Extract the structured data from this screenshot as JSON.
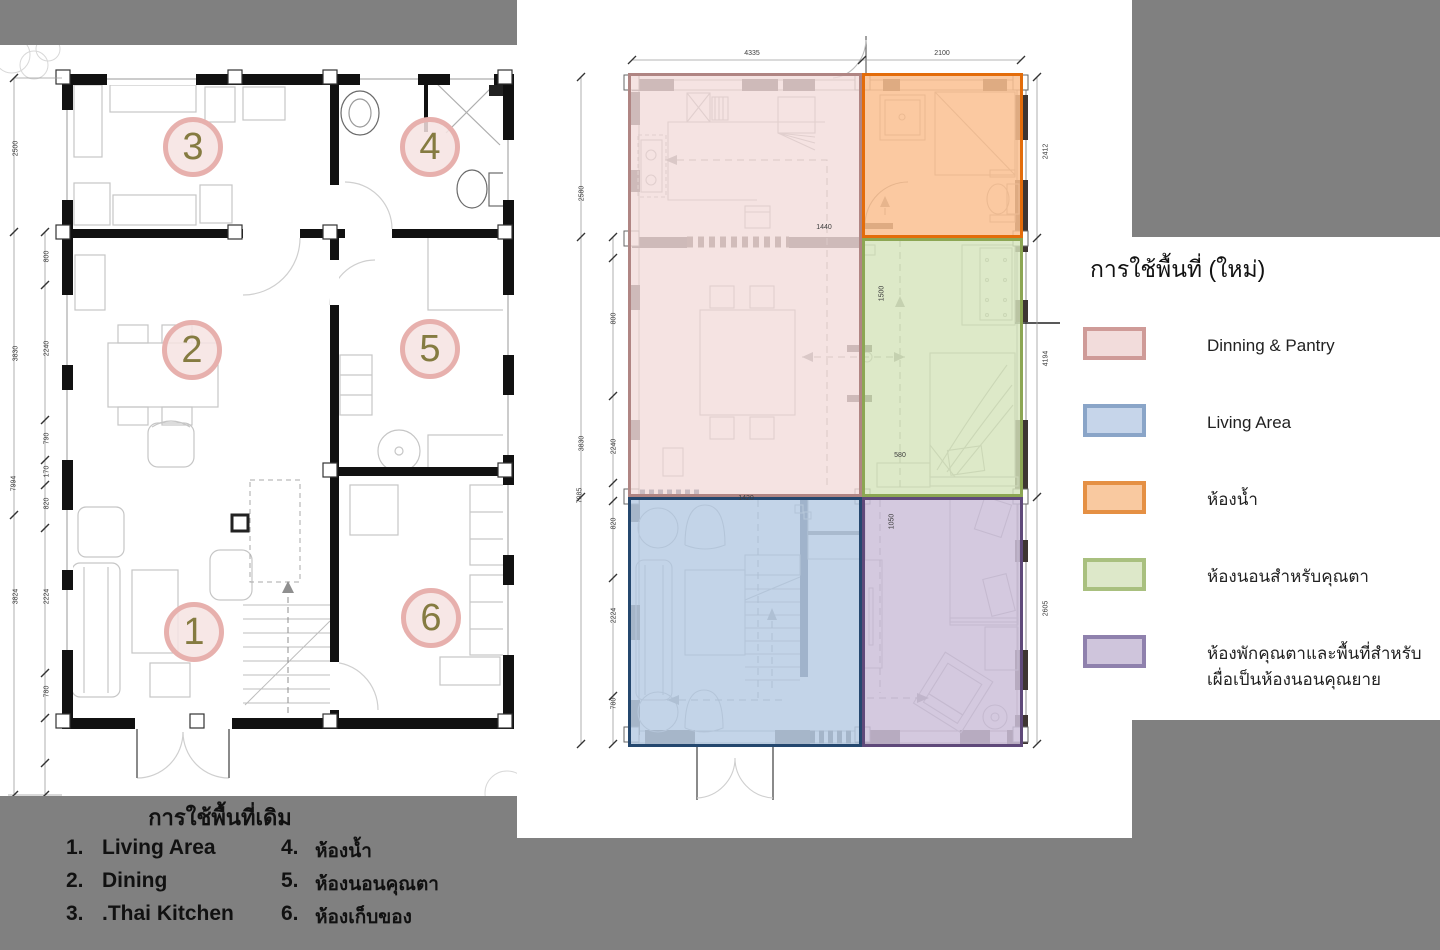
{
  "background_color": "#808080",
  "left_plan": {
    "caption": {
      "title": "การใช้พื้นที่เดิม",
      "items": [
        {
          "num": "1.",
          "label": "Living  Area"
        },
        {
          "num": "2.",
          "label": "Dining"
        },
        {
          "num": "3.",
          "label": ".Thai Kitchen"
        },
        {
          "num": "4.",
          "label": "ห้องน้ำ"
        },
        {
          "num": "5.",
          "label": "ห้องนอนคุณตา"
        },
        {
          "num": "6.",
          "label": "ห้องเก็บของ"
        }
      ]
    },
    "room_markers": [
      {
        "num": "3"
      },
      {
        "num": "4"
      },
      {
        "num": "2"
      },
      {
        "num": "5"
      },
      {
        "num": "1"
      },
      {
        "num": "6"
      }
    ],
    "marker_style": {
      "fill": "rgba(246,227,226,0.85)",
      "ring": "#e7b0ad",
      "number_color": "#857b41"
    },
    "dim_labels": [
      {
        "t": "2500",
        "x": -1,
        "y": 100,
        "r": -90
      },
      {
        "t": "3830",
        "x": -1,
        "y": 305,
        "r": -90
      },
      {
        "t": "7994",
        "x": -3,
        "y": 435,
        "r": -90
      },
      {
        "t": "3824",
        "x": -1,
        "y": 548,
        "r": -90
      },
      {
        "t": "800",
        "x": 30,
        "y": 208,
        "r": -90
      },
      {
        "t": "2240",
        "x": 30,
        "y": 300,
        "r": -90
      },
      {
        "t": "790",
        "x": 30,
        "y": 390,
        "r": -90
      },
      {
        "t": "170",
        "x": 30,
        "y": 423,
        "r": -90
      },
      {
        "t": "820",
        "x": 30,
        "y": 455,
        "r": -90
      },
      {
        "t": "2224",
        "x": 30,
        "y": 548,
        "r": -90
      },
      {
        "t": "780",
        "x": 30,
        "y": 643,
        "r": -90
      }
    ]
  },
  "new_plan": {
    "zones": [
      {
        "name": "dining-pantry",
        "fill": "rgba(242,220,219,0.8)",
        "border": "#b08583"
      },
      {
        "name": "bathroom",
        "fill": "rgba(250,192,144,0.85)",
        "border": "#e36c0a"
      },
      {
        "name": "bedroom-grandpa",
        "fill": "rgba(214,228,188,0.82)",
        "border": "#8ca653"
      },
      {
        "name": "living-area",
        "fill": "rgba(184,204,228,0.85)",
        "border": "#24476e"
      },
      {
        "name": "bedroom-flex",
        "fill": "rgba(204,192,217,0.85)",
        "border": "#5f497a"
      }
    ],
    "dim_labels": [
      {
        "t": "4335",
        "x": 218,
        "y": 50,
        "r": 0
      },
      {
        "t": "2100",
        "x": 408,
        "y": 50,
        "r": 0
      },
      {
        "t": "2580",
        "x": 48,
        "y": 190,
        "r": -90
      },
      {
        "t": "3830",
        "x": 48,
        "y": 440,
        "r": -90
      },
      {
        "t": "7985",
        "x": 46,
        "y": 492,
        "r": -90
      },
      {
        "t": "800",
        "x": 80,
        "y": 315,
        "r": -90
      },
      {
        "t": "2240",
        "x": 80,
        "y": 443,
        "r": -90
      },
      {
        "t": "820",
        "x": 80,
        "y": 520,
        "r": -90
      },
      {
        "t": "2224",
        "x": 80,
        "y": 612,
        "r": -90
      },
      {
        "t": "780",
        "x": 80,
        "y": 700,
        "r": -90
      },
      {
        "t": "2412",
        "x": 512,
        "y": 148,
        "r": -90
      },
      {
        "t": "4194",
        "x": 512,
        "y": 355,
        "r": -90
      },
      {
        "t": "2605",
        "x": 512,
        "y": 605,
        "r": -90
      },
      {
        "t": "1440",
        "x": 290,
        "y": 224,
        "r": 0
      },
      {
        "t": "1500",
        "x": 348,
        "y": 290,
        "r": -90
      },
      {
        "t": "580",
        "x": 366,
        "y": 452,
        "r": 0
      },
      {
        "t": "1420",
        "x": 212,
        "y": 495,
        "r": 0
      },
      {
        "t": "1050",
        "x": 358,
        "y": 518,
        "r": -90
      }
    ]
  },
  "legend": {
    "title": "การใช้พื้นที่ (ใหม่)",
    "items": [
      {
        "label": "Dinning & Pantry",
        "label2": "",
        "fill": "#f2dcdb",
        "border": "#cf9b98"
      },
      {
        "label": "Living Area",
        "label2": "",
        "fill": "#c6d5ea",
        "border": "#8aa5c8"
      },
      {
        "label": "ห้องน้ำ",
        "label2": "",
        "fill": "#f9c9a0",
        "border": "#e59044"
      },
      {
        "label": "ห้องนอนสำหรับคุณตา",
        "label2": "",
        "fill": "#dde8c9",
        "border": "#a9c07f"
      },
      {
        "label": "ห้องพักคุณตาและพื้นที่สำหรับ",
        "label2": "เผื่อเป็นห้องนอนคุณยาย",
        "fill": "#cfc5dc",
        "border": "#8f81ad"
      }
    ]
  }
}
